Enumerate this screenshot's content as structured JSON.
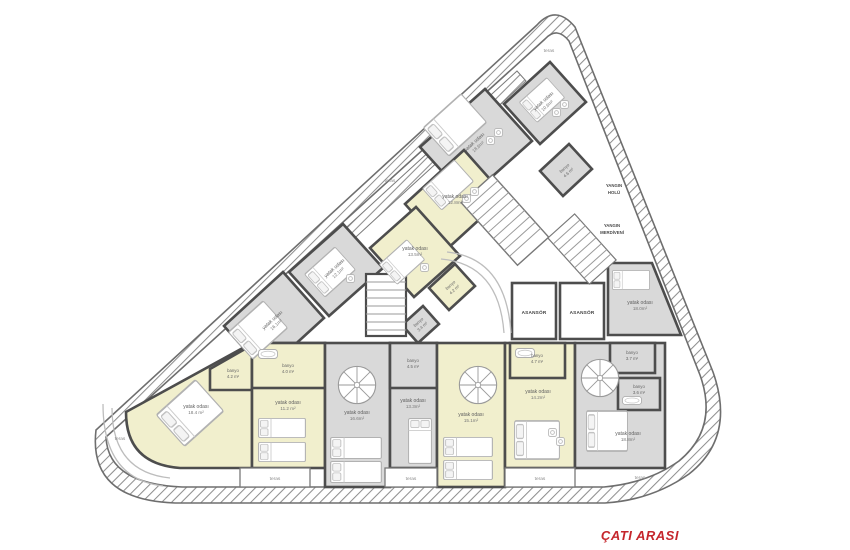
{
  "title": {
    "label": "ÇATI ARASI",
    "color": "#c5262c"
  },
  "labels": {
    "teras": "teras",
    "asansor": "ASANSÖR",
    "yangin_holu": [
      "YANGIN",
      "HOLÜ"
    ],
    "yangin_merdiveni": [
      "YANGIN",
      "MERDİVENİ"
    ]
  },
  "rooms": [
    {
      "name": "yatak odası",
      "area": "10.6m²"
    },
    {
      "name": "yatak odası",
      "area": "18.6m²"
    },
    {
      "name": "yatak odası",
      "area": "12.8m²"
    },
    {
      "name": "yatak odası",
      "area": "13.5m²"
    },
    {
      "name": "yatak odası",
      "area": "12.1m²"
    },
    {
      "name": "yatak odası",
      "area": "16.1m²"
    },
    {
      "name": "yatak odası",
      "area": "18.0m²"
    },
    {
      "name": "yatak odası",
      "area": "18.4 m²"
    },
    {
      "name": "yatak odası",
      "area": "11.2 m²"
    },
    {
      "name": "yatak odası",
      "area": "16.6m²"
    },
    {
      "name": "yatak odası",
      "area": "13.3m²"
    },
    {
      "name": "yatak odası",
      "area": "15.1m²"
    },
    {
      "name": "yatak odası",
      "area": "14.2m²"
    },
    {
      "name": "yatak odası",
      "area": "18.8m²"
    }
  ],
  "banyos": [
    {
      "name": "banyo",
      "area": "4.6 m²"
    },
    {
      "name": "banyo",
      "area": "4.2 m²"
    },
    {
      "name": "banyo",
      "area": "3.4 m²"
    },
    {
      "name": "banyo",
      "area": "4.2 m²"
    },
    {
      "name": "banyo",
      "area": "4.0 m²"
    },
    {
      "name": "banyo",
      "area": "4.5 m²"
    },
    {
      "name": "banyo",
      "area": "4.7 m²"
    },
    {
      "name": "banyo",
      "area": "3.7 m²"
    },
    {
      "name": "banyo",
      "area": "3.6 m²"
    }
  ]
}
